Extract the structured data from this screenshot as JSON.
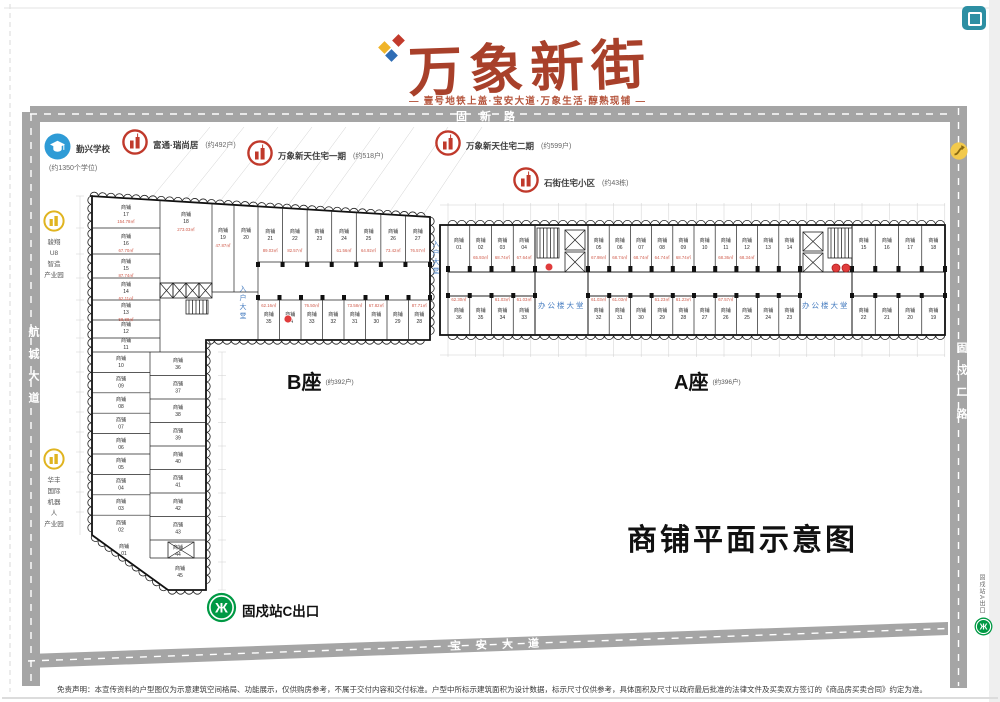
{
  "brand": {
    "name": "万象新街",
    "tagline": "— 壹号地铁上盖·宝安大道·万象生活·醇熟现铺 —"
  },
  "plan_title": "商铺平面示意图",
  "roads": {
    "top": "固新路",
    "left": "航城大道",
    "right": "固戍二路",
    "bottom": "宝安大道"
  },
  "pois": {
    "school": {
      "label": "勤兴学校",
      "sub": "(约1350个学位)"
    },
    "futong": {
      "label": "富通·瑞尚居",
      "sub": "(约492户)"
    },
    "phase1": {
      "label": "万象新天住宅一期",
      "sub": "(约518户)"
    },
    "phase2": {
      "label": "万象新天住宅二期",
      "sub": "(约599户)"
    },
    "shijie": {
      "label": "石街住宅小区",
      "sub": "(约43栋)"
    },
    "park1": {
      "lines": [
        "骏翔",
        "U8",
        "智造",
        "产业园"
      ]
    },
    "park2": {
      "lines": [
        "华丰",
        "国际",
        "机器",
        "人",
        "产业园"
      ]
    },
    "metro_c": {
      "label": "固戍站C出口"
    },
    "metro_a": {
      "label": "固戍站A出口"
    }
  },
  "blocks": {
    "b": {
      "label": "B座",
      "households": "(约392户)",
      "unit_prefix": "商铺",
      "lobby": "入户大堂",
      "col_left": [
        {
          "no": "17",
          "area": "154.78㎡"
        },
        {
          "no": "16",
          "area": "67.70㎡"
        },
        {
          "no": "15",
          "area": "87.74㎡"
        },
        {
          "no": "14",
          "area": "62.11㎡"
        },
        {
          "no": "13",
          "area": "58.88㎡"
        },
        {
          "no": "12"
        },
        {
          "no": "11"
        }
      ],
      "mid": [
        {
          "no": "18",
          "area": "273.03㎡"
        },
        {
          "no": "19",
          "area": "47.87㎡"
        },
        {
          "no": "20"
        }
      ],
      "row_top": [
        {
          "no": "21",
          "area": "89.03㎡"
        },
        {
          "no": "22",
          "area": "82.57㎡"
        },
        {
          "no": "23"
        },
        {
          "no": "24",
          "area": "61.56㎡"
        },
        {
          "no": "25",
          "area": "64.92㎡"
        },
        {
          "no": "26",
          "area": "73.42㎡"
        },
        {
          "no": "27",
          "area": "76.57㎡"
        }
      ],
      "row_bottom": [
        {
          "no": "35",
          "area": "62.16㎡"
        },
        {
          "no": "34"
        },
        {
          "no": "33",
          "area": "76.50㎡"
        },
        {
          "no": "32"
        },
        {
          "no": "31",
          "area": "73.58㎡"
        },
        {
          "no": "30",
          "area": "67.82㎡"
        },
        {
          "no": "29"
        },
        {
          "no": "28",
          "area": "87.71㎡"
        }
      ],
      "strip_left": [
        {
          "no": "10"
        },
        {
          "no": "09"
        },
        {
          "no": "08"
        },
        {
          "no": "07"
        },
        {
          "no": "06"
        },
        {
          "no": "05"
        },
        {
          "no": "04"
        },
        {
          "no": "03"
        },
        {
          "no": "02"
        }
      ],
      "strip_right": [
        {
          "no": "36"
        },
        {
          "no": "37"
        },
        {
          "no": "38"
        },
        {
          "no": "39"
        },
        {
          "no": "40"
        },
        {
          "no": "41"
        },
        {
          "no": "42"
        },
        {
          "no": "43"
        },
        {
          "no": "44"
        }
      ],
      "corner_unit": {
        "no": "01"
      },
      "strip_bottom_unit": {
        "no": "45"
      }
    },
    "a": {
      "label": "A座",
      "households": "(约396户)",
      "unit_prefix": "商铺",
      "lobby": "办公楼大堂",
      "top_seg1": [
        {
          "no": "01"
        },
        {
          "no": "02",
          "area": "65.93㎡"
        },
        {
          "no": "03",
          "area": "68.74㎡"
        },
        {
          "no": "04",
          "area": "67.64㎡"
        }
      ],
      "top_seg2": [
        {
          "no": "05",
          "area": "67.98㎡"
        },
        {
          "no": "06",
          "area": "68.74㎡"
        },
        {
          "no": "07",
          "area": "68.74㎡"
        },
        {
          "no": "08",
          "area": "64.74㎡"
        },
        {
          "no": "09",
          "area": "68.74㎡"
        },
        {
          "no": "10"
        },
        {
          "no": "11",
          "area": "68.36㎡"
        },
        {
          "no": "12",
          "area": "68.34㎡"
        },
        {
          "no": "13"
        },
        {
          "no": "14"
        }
      ],
      "top_seg3": [
        {
          "no": "15"
        },
        {
          "no": "16"
        },
        {
          "no": "17"
        },
        {
          "no": "18"
        }
      ],
      "bottom_seg1": [
        {
          "no": "36",
          "area": "62.30㎡"
        },
        {
          "no": "35"
        },
        {
          "no": "34",
          "area": "61.03㎡"
        },
        {
          "no": "33",
          "area": "61.03㎡"
        }
      ],
      "bottom_seg2": [
        {
          "no": "32",
          "area": "61.03㎡"
        },
        {
          "no": "31",
          "area": "61.03㎡"
        },
        {
          "no": "30"
        },
        {
          "no": "29",
          "area": "61.23㎡"
        },
        {
          "no": "28",
          "area": "61.23㎡"
        },
        {
          "no": "27"
        },
        {
          "no": "26",
          "area": "67.57㎡"
        },
        {
          "no": "25"
        },
        {
          "no": "24"
        },
        {
          "no": "23"
        }
      ],
      "bottom_seg3": [
        {
          "no": "22"
        },
        {
          "no": "21"
        },
        {
          "no": "20"
        },
        {
          "no": "19"
        }
      ]
    }
  },
  "disclaimer": "免责声明：本宣传资料的户型图仅为示意建筑空间格局、功能展示，仅供购房参考，不属于交付内容和交付标准。户型中所标示建筑面积为设计数据，标示尺寸仅供参考，具体面积及尺寸以政府最后批准的法律文件及买卖双方签订的《商品房买卖合同》约定为准。",
  "colors": {
    "brand_red": "#a8402a",
    "area_red": "#cf5a4a",
    "road_gray": "#a5a5a5",
    "lobby_blue": "#4a7fc1",
    "metro_green": "#009944",
    "icon_red": "#c0392b",
    "icon_yellow": "#e0b420",
    "school_blue": "#2e9bd6",
    "marker_red": "#e03c3c"
  }
}
